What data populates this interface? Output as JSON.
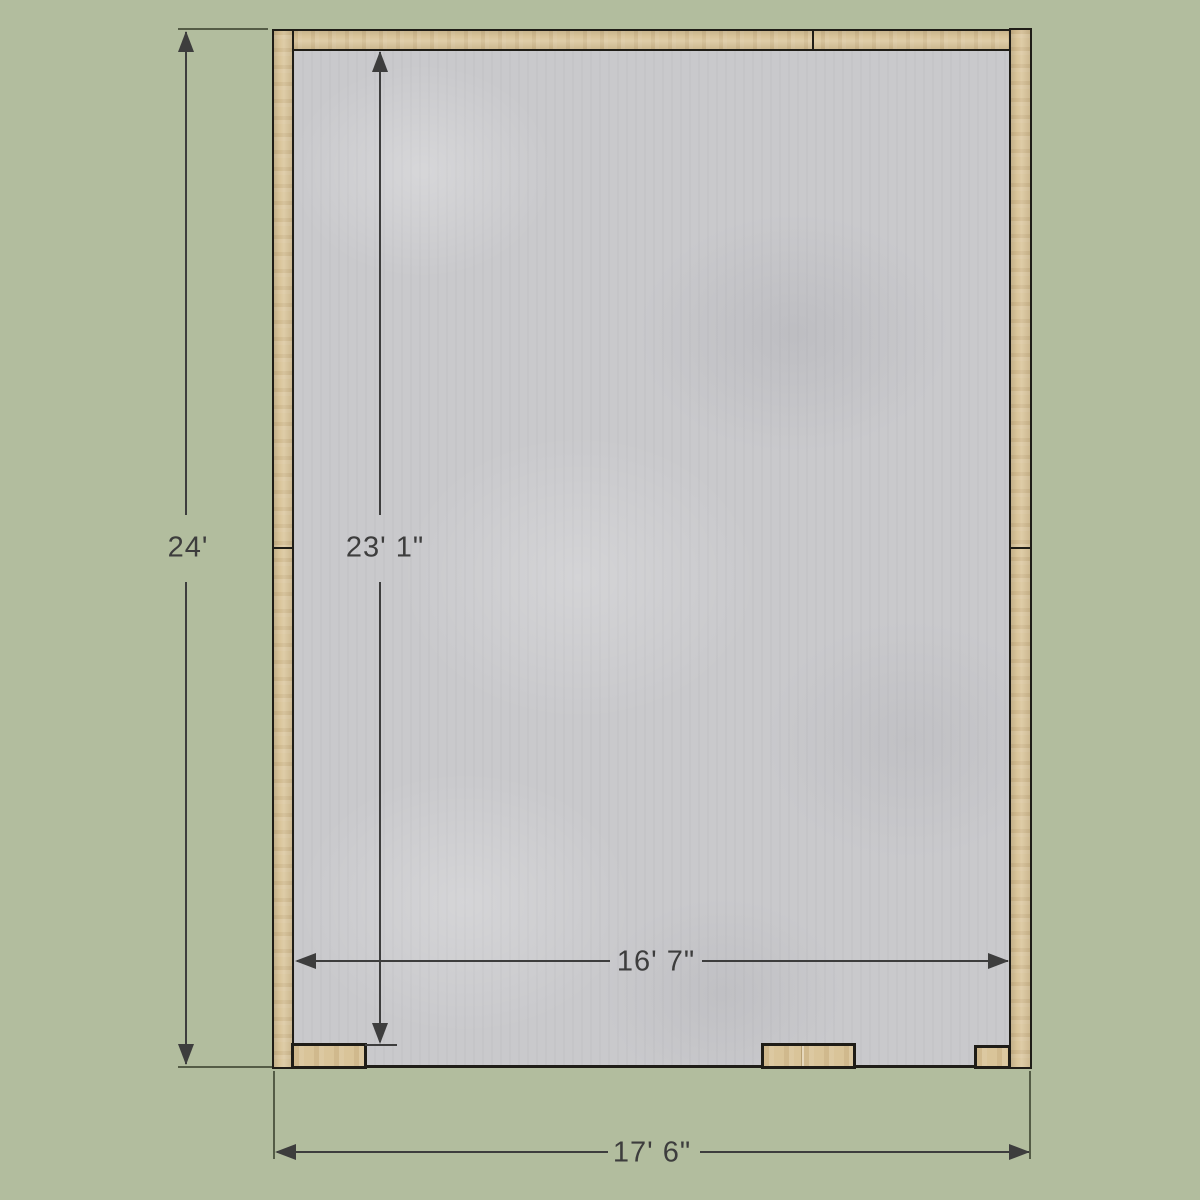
{
  "theme": {
    "background": "#b2bd9e",
    "wall_fill": "#d9c499",
    "floor_fill": "#c9c9cc",
    "outline": "#1f1d17",
    "dimension": "#3d3d3d"
  },
  "structure": {
    "floor": "concrete-slab-floor",
    "walls": [
      "left-wall",
      "top-wall",
      "right-wall"
    ],
    "bottom_blocks": [
      "bottom-left-stud",
      "bottom-center-stud",
      "bottom-right-stud"
    ]
  },
  "dimensions": {
    "overall_height": {
      "label": "24'",
      "orientation": "vertical"
    },
    "interior_height": {
      "label": "23' 1\"",
      "orientation": "vertical"
    },
    "interior_width": {
      "label": "16' 7\"",
      "orientation": "horizontal"
    },
    "overall_width": {
      "label": "17' 6\"",
      "orientation": "horizontal"
    }
  },
  "icons": [
    "arrow-up-icon",
    "arrow-down-icon",
    "arrow-left-icon",
    "arrow-right-icon"
  ]
}
